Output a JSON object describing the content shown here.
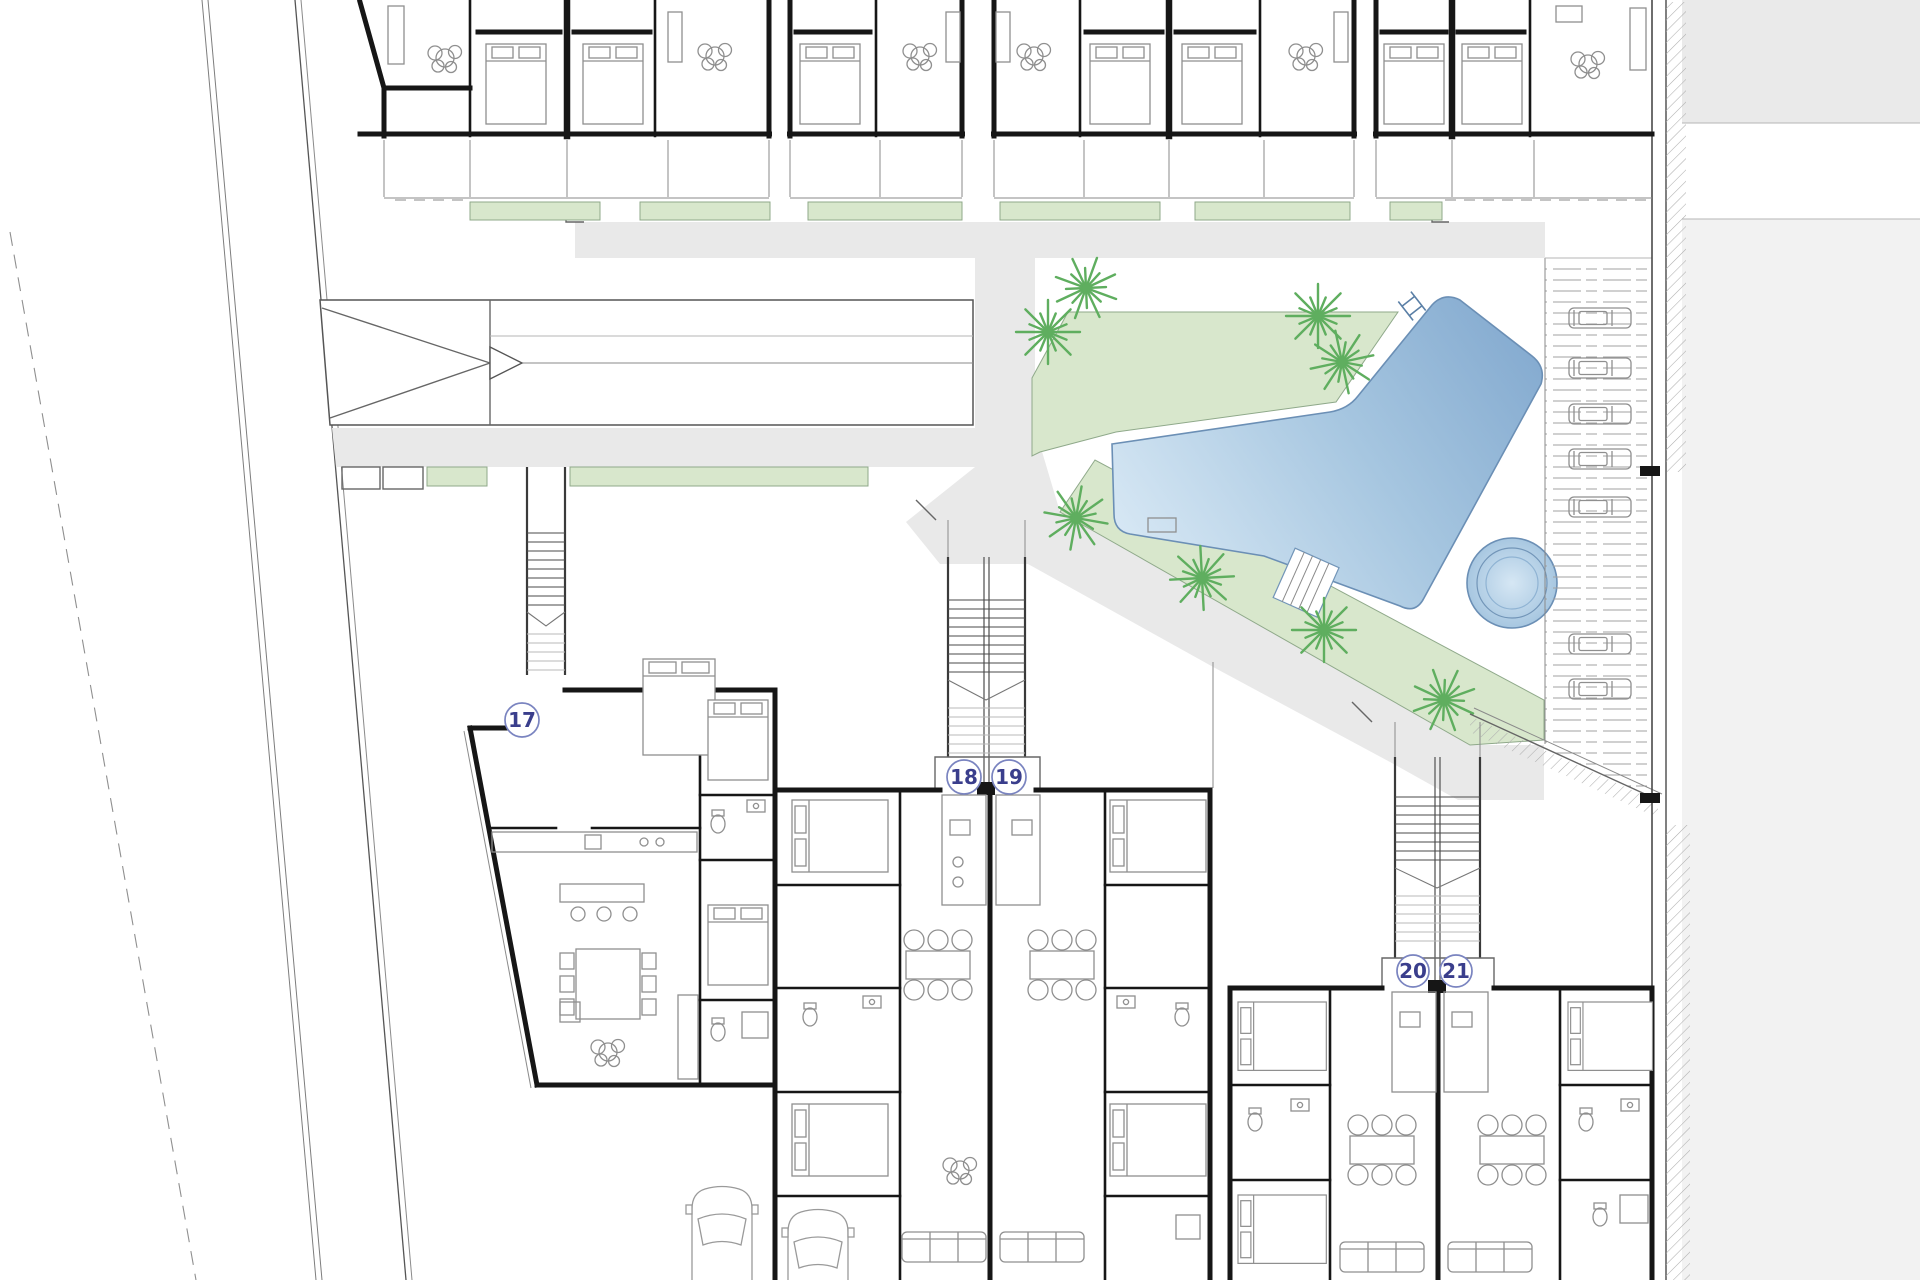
{
  "plan": {
    "units": [
      {
        "label": "17"
      },
      {
        "label": "18"
      },
      {
        "label": "19"
      },
      {
        "label": "20"
      },
      {
        "label": "21"
      }
    ]
  },
  "colors": {
    "wall": "#161616",
    "grass": "#d8e7cc",
    "grass_border": "#8fa98a",
    "path": "#e9e9e9",
    "road": "#f2f2f2",
    "road_dark": "#eaeaea",
    "pool_light": "#d6e7f4",
    "pool_mid": "#a6c6e0",
    "pool_dark": "#85abd0",
    "pool_border": "#6b8fb5",
    "palm": "#5fae5f",
    "furniture": "#8f8f8f",
    "label_ink": "#3a3e8c",
    "label_ring": "#7a84c0"
  },
  "icons": {
    "palm": "palm-tree-icon",
    "plant": "plant-icon",
    "bed": "bed-icon",
    "car_parked": "parked-car-icon",
    "car": "car-icon",
    "stairs": "stairs-icon",
    "ramp_arrow": "ramp-arrow-icon",
    "pool": "swimming-pool",
    "jacuzzi": "jacuzzi-circle",
    "dining": "dining-table-icon",
    "sofa": "sofa-icon",
    "toilet": "toilet-icon",
    "sink": "sink-icon"
  }
}
